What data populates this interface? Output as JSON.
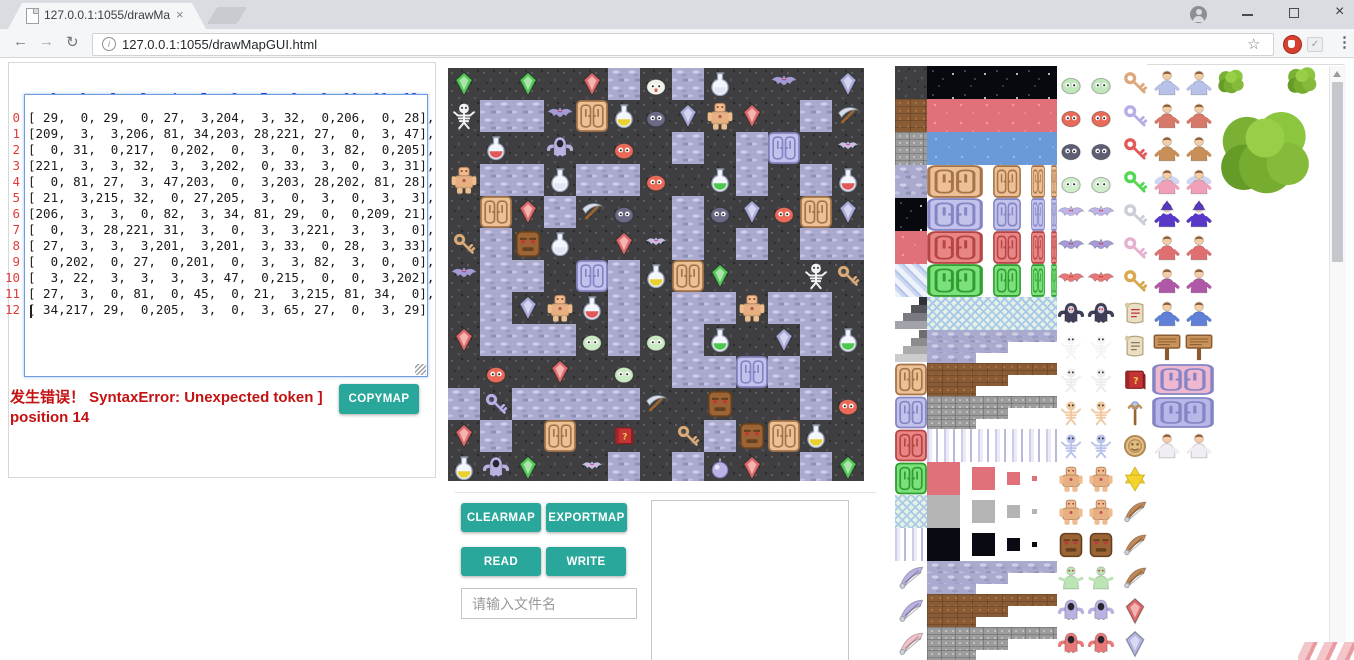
{
  "browser": {
    "tab": {
      "title": "127.0.0.1:1055/drawMa",
      "close_glyph": "×"
    },
    "url": "127.0.0.1:1055/drawMapGUI.html",
    "icons": {
      "back": "←",
      "forward": "→",
      "reload": "↻",
      "info": "i",
      "bookmark_star": "☆",
      "menu": "⋮",
      "close": "×",
      "extension_check": "✓"
    }
  },
  "left_panel": {
    "col_headers": [
      "0",
      "1",
      "2",
      "3",
      "4",
      "5",
      "6",
      "7",
      "8",
      "9",
      "10",
      "11",
      "12"
    ],
    "row_headers": [
      "0",
      "1",
      "2",
      "3",
      "4",
      "5",
      "6",
      "7",
      "8",
      "9",
      "10",
      "11",
      "12"
    ],
    "error_line1": "发生错误！ SyntaxError: Unexpected token ]",
    "error_line2": "position 14",
    "copymap_label": "COPYMAP"
  },
  "map_editor": {
    "tile_size": 32,
    "rows": 13,
    "cols": 13,
    "grid": [
      [
        29,
        0,
        29,
        0,
        27,
        3,
        204,
        3,
        32,
        0,
        206,
        0,
        28
      ],
      [
        209,
        3,
        3,
        206,
        81,
        34,
        203,
        28,
        221,
        27,
        0,
        3,
        47
      ],
      [
        0,
        31,
        0,
        217,
        0,
        202,
        0,
        3,
        0,
        3,
        82,
        0,
        205
      ],
      [
        221,
        3,
        3,
        32,
        3,
        3,
        202,
        0,
        33,
        3,
        0,
        3,
        31
      ],
      [
        0,
        81,
        27,
        3,
        47,
        203,
        0,
        3,
        203,
        28,
        202,
        81,
        28
      ],
      [
        21,
        3,
        215,
        32,
        0,
        27,
        205,
        3,
        0,
        3,
        0,
        3,
        3
      ],
      [
        206,
        3,
        3,
        0,
        82,
        3,
        34,
        81,
        29,
        0,
        0,
        209,
        21
      ],
      [
        0,
        3,
        28,
        221,
        31,
        3,
        0,
        3,
        3,
        221,
        3,
        3,
        0
      ],
      [
        27,
        3,
        3,
        3,
        201,
        3,
        201,
        3,
        33,
        0,
        28,
        3,
        33
      ],
      [
        0,
        202,
        0,
        27,
        0,
        201,
        0,
        3,
        3,
        82,
        3,
        0,
        0
      ],
      [
        3,
        22,
        3,
        3,
        3,
        3,
        47,
        0,
        215,
        0,
        0,
        3,
        202
      ],
      [
        27,
        3,
        0,
        81,
        0,
        45,
        0,
        21,
        3,
        215,
        81,
        34,
        0
      ],
      [
        34,
        217,
        29,
        0,
        205,
        3,
        0,
        3,
        65,
        27,
        0,
        3,
        29
      ]
    ],
    "tile_legend": {
      "0": "dark-stone-floor",
      "3": "lavender-cobblestone",
      "21": "tan-key",
      "22": "purple-key",
      "27": "red-gem",
      "28": "purple-gem",
      "29": "green-gem",
      "31": "red-potion-flask",
      "32": "empty-flask",
      "33": "green-potion-flask",
      "34": "yellow-potion-flask",
      "45": "red-question-book",
      "47": "pickaxe",
      "65": "purple-orb",
      "81": "brown-carved-door",
      "82": "lavender-carved-door",
      "201": "green-slime",
      "202": "red-slime",
      "203": "dark-slime",
      "204": "white-slime",
      "205": "small-bat",
      "206": "purple-bat",
      "209": "skeleton",
      "215": "stone-face",
      "217": "ghost",
      "221": "brown-golem"
    }
  },
  "controls": {
    "clearmap": "CLEARMAP",
    "exportmap": "EXPORTMAP",
    "read": "READ",
    "write": "WRITE",
    "filename_placeholder": "请输入文件名"
  },
  "tileset": {
    "rows": [
      [
        [
          "tex",
          "dark"
        ],
        [
          "tex",
          "star"
        ],
        [
          "slime",
          "#c2e6bc"
        ],
        [
          "key",
          "#dca87c"
        ],
        [
          "person",
          "#b8c2e8"
        ]
      ],
      [
        [
          "tex",
          "brown"
        ],
        [
          "tex",
          "redt"
        ],
        [
          "slime",
          "#e86a58"
        ],
        [
          "key",
          "#b6aee6"
        ],
        [
          "person",
          "#d87868"
        ]
      ],
      [
        [
          "tex",
          "gray"
        ],
        [
          "tex",
          "bluet"
        ],
        [
          "slime",
          "#5e5e74"
        ],
        [
          "key",
          "#e05a5a"
        ],
        [
          "person",
          "#c89058"
        ]
      ],
      [
        [
          "tex",
          "lav"
        ],
        [
          "doorrow",
          "brown"
        ],
        [
          "slime",
          "#cfeccb"
        ],
        [
          "key",
          "#52d852"
        ],
        [
          "fairy",
          "#f0a0b8"
        ]
      ],
      [
        [
          "tex",
          "star"
        ],
        [
          "doorrow",
          "lav"
        ],
        [
          "bat",
          "#bdb5e8"
        ],
        [
          "key",
          "#caced6"
        ],
        [
          "wizard",
          "#5838c8"
        ]
      ],
      [
        [
          "tex",
          "redt"
        ],
        [
          "doorrow",
          "red"
        ],
        [
          "bat",
          "#a49bd8"
        ],
        [
          "key",
          "#e8b0d0"
        ],
        [
          "person",
          "#e07070"
        ]
      ],
      [
        [
          "tex",
          "stripe"
        ],
        [
          "doorrow",
          "green"
        ],
        [
          "bat",
          "#e87878"
        ],
        [
          "key",
          "#d8a850"
        ],
        [
          "person",
          "#b058a8"
        ]
      ],
      [
        [
          "stairs",
          "dark"
        ],
        [
          "lattice",
          ""
        ],
        [
          "vamp",
          "#3e3e58"
        ],
        [
          "scroll",
          "#c03040"
        ],
        [
          "person",
          "#6080d8"
        ]
      ],
      [
        [
          "stairs",
          "gray"
        ],
        [
          "steps",
          "lav"
        ],
        [
          "skel",
          "#f4f4f4"
        ],
        [
          "scroll",
          "#8a7850"
        ],
        [
          "sign",
          ""
        ]
      ],
      [
        [
          "door",
          "brown"
        ],
        [
          "steps",
          "brown"
        ],
        [
          "skel",
          "#ececec"
        ],
        [
          "book",
          ""
        ],
        [
          "wall",
          "#f0b8d0"
        ]
      ],
      [
        [
          "door",
          "lav"
        ],
        [
          "steps",
          "gray"
        ],
        [
          "skel",
          "#f0c8a0"
        ],
        [
          "staff",
          ""
        ],
        [
          "wall",
          "#b8b8e8"
        ]
      ],
      [
        [
          "door",
          "red"
        ],
        [
          "cols",
          ""
        ],
        [
          "skel",
          "#b8c2ea"
        ],
        [
          "medal",
          ""
        ],
        [
          "person",
          "#f0eef4"
        ]
      ],
      [
        [
          "door",
          "green"
        ],
        [
          "sqrow",
          "#e0707a"
        ],
        [
          "golem",
          ""
        ],
        [
          "star",
          ""
        ],
        null
      ],
      [
        [
          "lattice",
          ""
        ],
        [
          "sqrow",
          "#b4b4b4"
        ],
        [
          "golem",
          ""
        ],
        [
          "wing",
          "#c08858"
        ],
        null
      ],
      [
        [
          "cols",
          ""
        ],
        [
          "sqrow",
          "#0a0a12"
        ],
        [
          "face",
          ""
        ],
        [
          "wing",
          "#c08858"
        ],
        null
      ],
      [
        [
          "wing",
          "#b9b1e2"
        ],
        [
          "steps",
          "lav"
        ],
        [
          "zombie",
          "#bce4b4"
        ],
        [
          "wing",
          "#c08858"
        ],
        null
      ],
      [
        [
          "wing",
          "#b9b1e2"
        ],
        [
          "steps",
          "brown"
        ],
        [
          "ghost",
          "#b9b1e2"
        ],
        [
          "gem",
          "#e06a6a"
        ],
        null
      ],
      [
        [
          "wing",
          "#f0c2ca"
        ],
        [
          "steps",
          "gray"
        ],
        [
          "ghost",
          "#e87878"
        ],
        [
          "gem",
          "#b4b4e4"
        ],
        null
      ]
    ],
    "trees": [
      {
        "x": 1216,
        "y": 66,
        "s": 30
      },
      {
        "x": 1285,
        "y": 63,
        "s": 34
      },
      {
        "x": 1213,
        "y": 99,
        "s": 104
      }
    ]
  },
  "colors": {
    "accent_teal": "#2aa79b",
    "error_red": "#c41212",
    "header_blue": "#2432cc",
    "row_number_red": "#e23b3b",
    "textarea_border": "#6f9ce0",
    "map_dark_tile": "#3f3f41",
    "map_lavender_tile": "#a9aacd"
  }
}
